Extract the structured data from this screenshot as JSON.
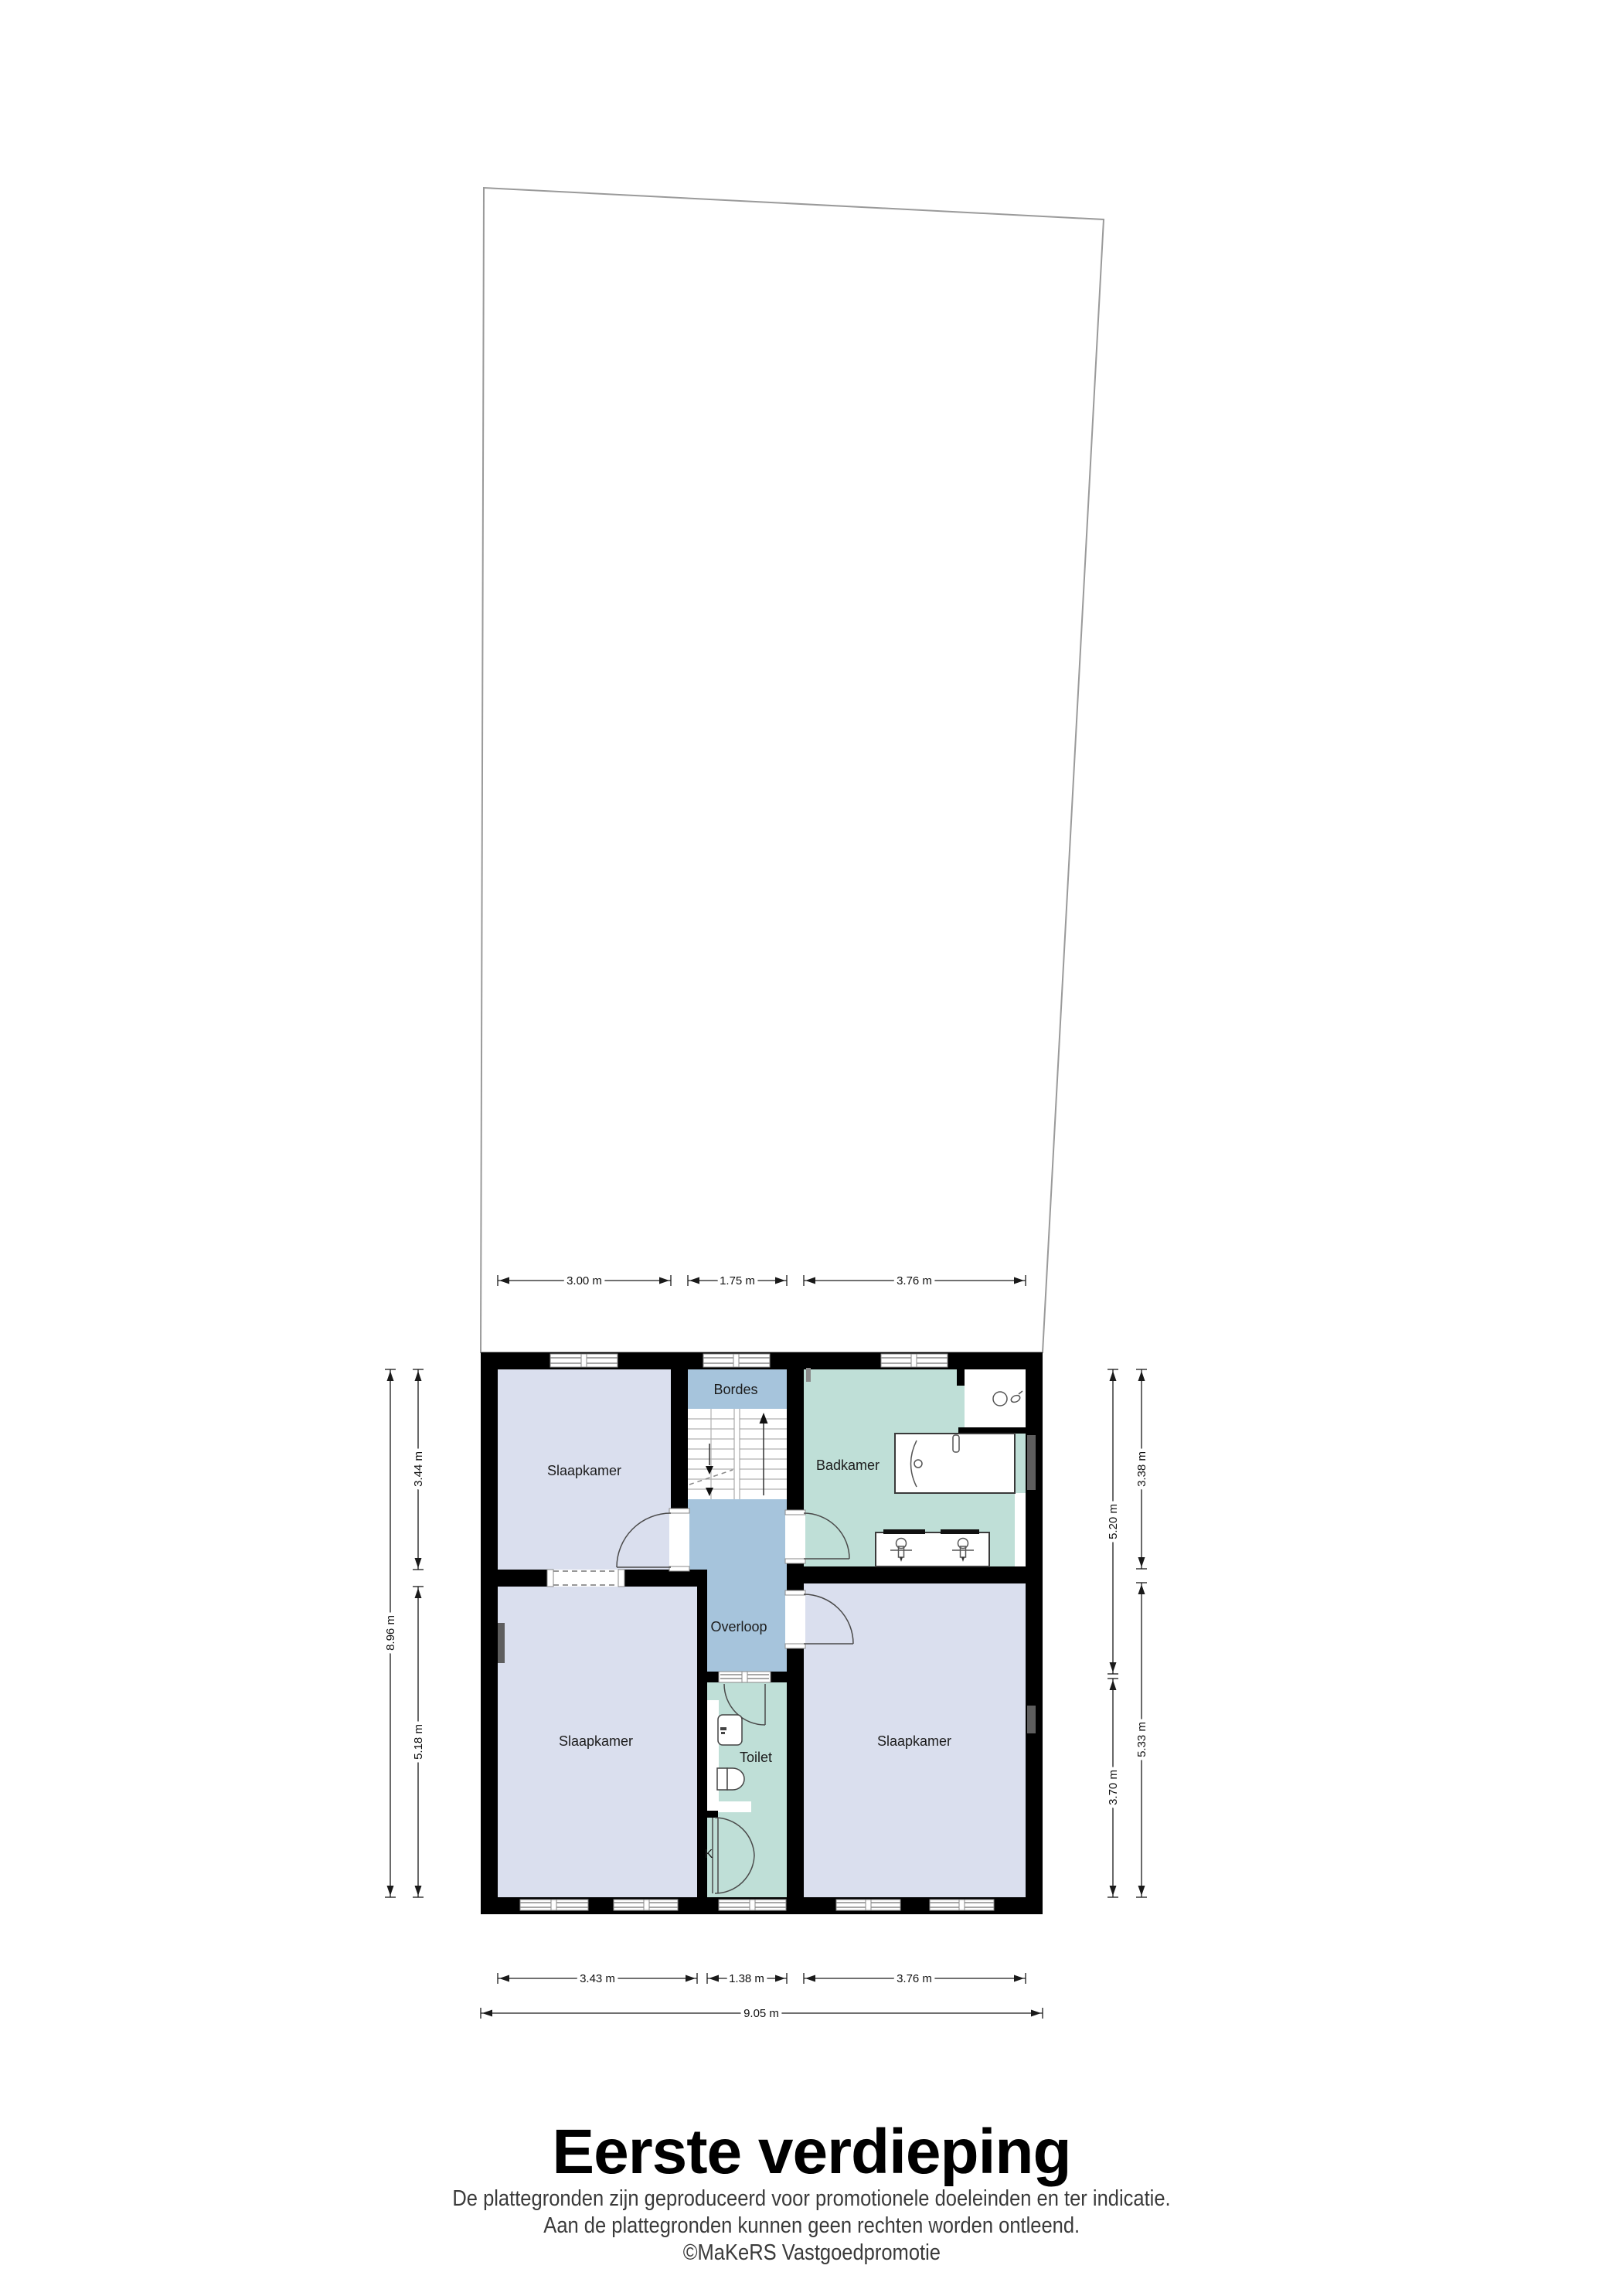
{
  "title": "Eerste verdieping",
  "footer": {
    "line1": "De plattegronden zijn geproduceerd voor promotionele doeleinden en ter indicatie.",
    "line2": "Aan de plattegronden kunnen geen rechten worden ontleend.",
    "credit": "©MaKeRS Vastgoedpromotie"
  },
  "colors": {
    "bedroom": "#dadfee",
    "circulation": "#a6c4dc",
    "sanitary": "#bfdfd7",
    "wall": "#000000",
    "dimension": "#1a1a1a"
  },
  "plan": {
    "floor_name": "Eerste verdieping",
    "rooms": {
      "slaapkamer_tl": "Slaapkamer",
      "bordes": "Bordes",
      "badkamer": "Badkamer",
      "overloop": "Overloop",
      "slaapkamer_bl": "Slaapkamer",
      "toilet": "Toilet",
      "slaapkamer_br": "Slaapkamer",
      "kast": "K"
    },
    "dims": {
      "top": [
        "3.00 m",
        "1.75 m",
        "3.76 m"
      ],
      "bottom": [
        "3.43 m",
        "1.38 m",
        "3.76 m"
      ],
      "total_width": "9.05 m",
      "left_outer": "8.96 m",
      "left_inner": [
        "3.44 m",
        "5.18 m"
      ],
      "right_inner": [
        "5.20 m",
        "3.70 m"
      ],
      "right_outer": [
        "3.38 m",
        "5.33 m"
      ]
    }
  }
}
